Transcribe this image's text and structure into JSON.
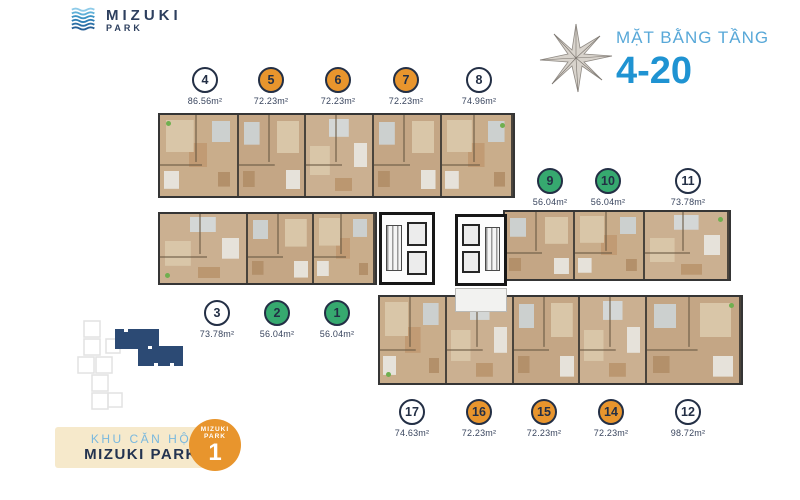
{
  "logo": {
    "line1": "MIZUKI",
    "line2": "PARK"
  },
  "header": {
    "title": "MẶT BẰNG TẦNG",
    "floors": "4-20"
  },
  "legend_badge": {
    "subtitle": "KHU CĂN HỘ",
    "title": "MIZUKI PARK",
    "tower_label_line1": "MIZUKI",
    "tower_label_line2": "PARK",
    "tower_number": "1"
  },
  "colors": {
    "accent_blue": "#1f93d2",
    "light_blue": "#58a8d8",
    "navy": "#232f45",
    "orange_unit": "#e8952d",
    "green_unit": "#36a96f",
    "white_unit": "#ffffff",
    "badge_cream": "#f6e9cb",
    "keymap_navy": "#2c4a74"
  },
  "units": [
    {
      "id": "4",
      "area": "86.56m²",
      "type": "white",
      "group": "top"
    },
    {
      "id": "5",
      "area": "72.23m²",
      "type": "orange",
      "group": "top"
    },
    {
      "id": "6",
      "area": "72.23m²",
      "type": "orange",
      "group": "top"
    },
    {
      "id": "7",
      "area": "72.23m²",
      "type": "orange",
      "group": "top"
    },
    {
      "id": "8",
      "area": "74.96m²",
      "type": "white",
      "group": "top"
    },
    {
      "id": "9",
      "area": "56.04m²",
      "type": "green",
      "group": "right"
    },
    {
      "id": "10",
      "area": "56.04m²",
      "type": "green",
      "group": "right"
    },
    {
      "id": "11",
      "area": "73.78m²",
      "type": "white",
      "group": "right"
    },
    {
      "id": "3",
      "area": "73.78m²",
      "type": "white",
      "group": "left"
    },
    {
      "id": "2",
      "area": "56.04m²",
      "type": "green",
      "group": "left"
    },
    {
      "id": "1",
      "area": "56.04m²",
      "type": "green",
      "group": "left"
    },
    {
      "id": "17",
      "area": "74.63m²",
      "type": "white",
      "group": "bottom"
    },
    {
      "id": "16",
      "area": "72.23m²",
      "type": "orange",
      "group": "bottom"
    },
    {
      "id": "15",
      "area": "72.23m²",
      "type": "orange",
      "group": "bottom"
    },
    {
      "id": "14",
      "area": "72.23m²",
      "type": "orange",
      "group": "bottom"
    },
    {
      "id": "12",
      "area": "98.72m²",
      "type": "white",
      "group": "bottom"
    }
  ]
}
